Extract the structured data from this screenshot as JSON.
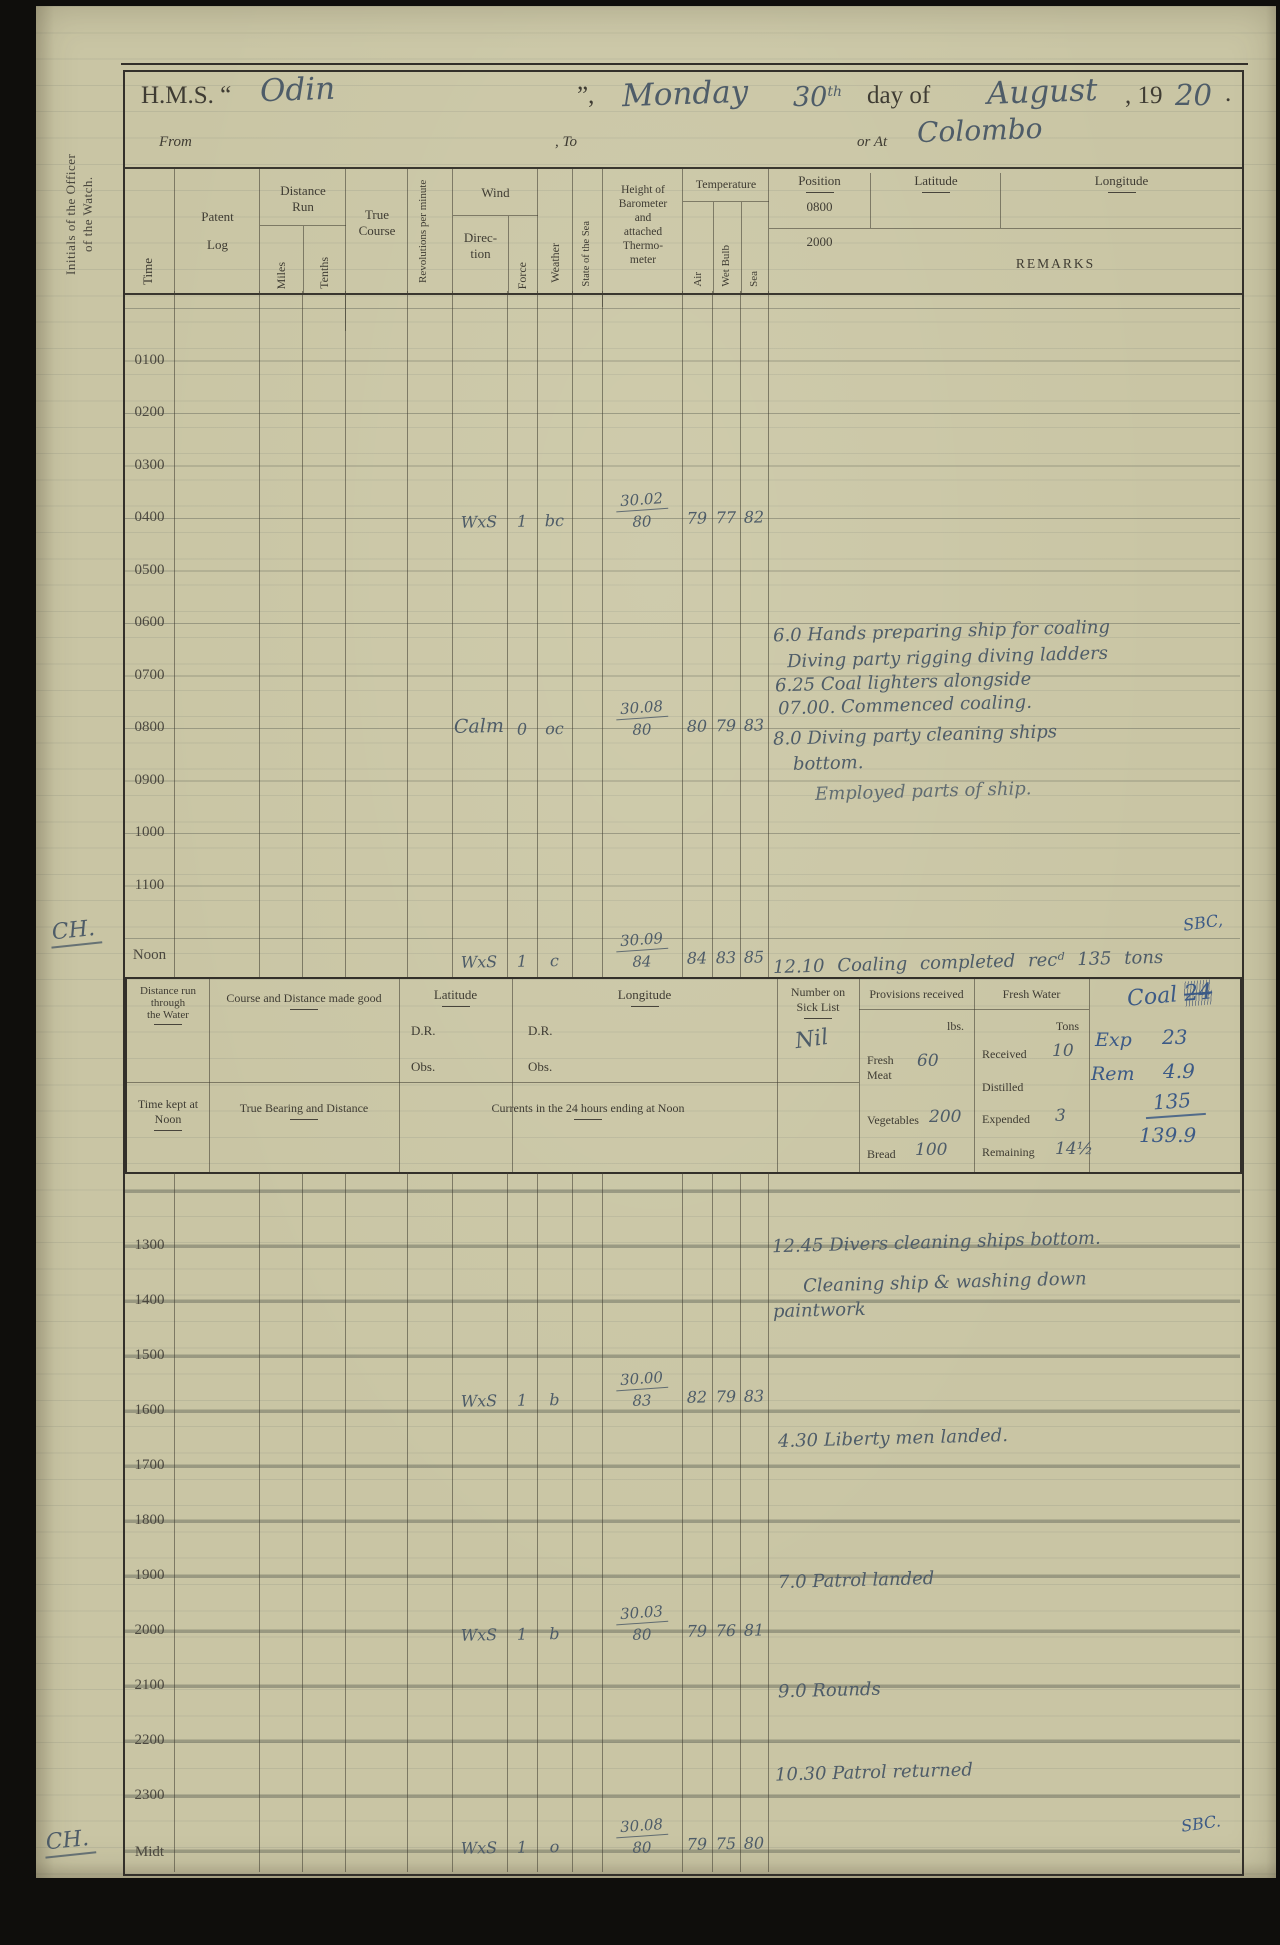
{
  "page": {
    "title_prefix": "H.M.S. “",
    "ship_name": "Odin",
    "title_mid": "”,",
    "day_name": "Monday",
    "day_number": "30",
    "day_ordinal": "th",
    "day_of_text": "day of",
    "month": "August",
    "year_prefix": ", 19",
    "year_hw": "20",
    "year_period": ".",
    "from_label": "From",
    "to_label": ", To",
    "or_at_label": "or At",
    "location": "Colombo"
  },
  "margin": {
    "initials_label": "Initials of the Officer\nof the Watch.",
    "noon_initials": "CH.",
    "midnight_initials": "CH."
  },
  "table": {
    "col_time": "Time",
    "col_patent_1": "Patent",
    "col_patent_2": "Log",
    "col_distance_run": "Distance\nRun",
    "col_miles": "Miles",
    "col_tenths": "Tenths",
    "col_true_course": "True\nCourse",
    "col_revolutions": "Revolutions per minute",
    "col_wind": "Wind",
    "col_direction": "Direc-\ntion",
    "col_force": "Force",
    "col_weather": "Weather",
    "col_state_sea": "State of the Sea",
    "col_barometer": "Height of\nBarometer\nand\nattached\nThermo-\nmeter",
    "col_temperature": "Temperature",
    "col_air": "Air",
    "col_wet_bulb": "Wet Bulb",
    "col_sea": "Sea",
    "col_position": "Position",
    "pos_row_1": "0800",
    "pos_row_2": "2000",
    "col_latitude": "Latitude",
    "col_longitude": "Longitude",
    "col_remarks": "REMARKS",
    "times_top": [
      "0100",
      "0200",
      "0300",
      "0400",
      "0500",
      "0600",
      "0700",
      "0800",
      "0900",
      "1000",
      "1100",
      "Noon"
    ],
    "times_bottom": [
      "1300",
      "1400",
      "1500",
      "1600",
      "1700",
      "1800",
      "1900",
      "2000",
      "2100",
      "2200",
      "2300",
      "Midt"
    ]
  },
  "observations": {
    "h0400": {
      "wind_direction": "WxS",
      "force": "1",
      "weather": "bc",
      "barometer_top": "30.02",
      "barometer_bottom": "80",
      "air": "79",
      "wet_bulb": "77",
      "sea": "82"
    },
    "h0800": {
      "wind_direction": "Calm",
      "force": "0",
      "weather": "oc",
      "barometer_top": "30.08",
      "barometer_bottom": "80",
      "air": "80",
      "wet_bulb": "79",
      "sea": "83"
    },
    "noon": {
      "wind_direction": "WxS",
      "force": "1",
      "weather": "c",
      "barometer_top": "30.09",
      "barometer_bottom": "84",
      "air": "84",
      "wet_bulb": "83",
      "sea": "85"
    },
    "h1600": {
      "wind_direction": "WxS",
      "force": "1",
      "weather": "b",
      "barometer_top": "30.00",
      "barometer_bottom": "83",
      "air": "82",
      "wet_bulb": "79",
      "sea": "83"
    },
    "h2000": {
      "wind_direction": "WxS",
      "force": "1",
      "weather": "b",
      "barometer_top": "30.03",
      "barometer_bottom": "80",
      "air": "79",
      "wet_bulb": "76",
      "sea": "81"
    },
    "midnight": {
      "wind_direction": "WxS",
      "force": "1",
      "weather": "o",
      "barometer_top": "30.08",
      "barometer_bottom": "80",
      "air": "79",
      "wet_bulb": "75",
      "sea": "80"
    }
  },
  "remarks": {
    "morning_1": "6.0 Hands preparing ship for coaling",
    "morning_2": "Diving party rigging diving ladders",
    "morning_3": "6.25 Coal lighters alongside",
    "morning_4": "07.00. Commenced coaling.",
    "forenoon_1": "8.0 Diving party cleaning ships",
    "forenoon_2": "bottom.",
    "forenoon_3": "Employed parts of ship.",
    "noon_entry": "12.10 Coaling completed recᵈ 135 tons",
    "noon_watch_initials": "SBC,",
    "afternoon_1": "12.45 Divers cleaning ships bottom.",
    "afternoon_2": "Cleaning ship & washing down",
    "afternoon_3": "paintwork",
    "evening_1600": "4.30 Liberty men landed.",
    "evening_1900": "7.0 Patrol landed",
    "night_2100": "9.0 Rounds",
    "night_2200": "10.30 Patrol returned",
    "midnight_watch_initials": "SBC."
  },
  "noon_summary": {
    "distance_water_label": "Distance run through\nthe Water",
    "course_made_good_label": "Course and Distance made good",
    "latitude_label": "Latitude",
    "longitude_label": "Longitude",
    "dr_label": "D.R.",
    "obs_label": "Obs.",
    "time_kept_label": "Time kept at\nNoon",
    "true_bearing_label": "True Bearing and Distance",
    "currents_label": "Currents in the 24 hours ending at Noon",
    "sick_list_label": "Number on\nSick List",
    "sick_list_value": "Nil",
    "provisions_label": "Provisions received",
    "lbs_label": "lbs.",
    "fresh_meat_label": "Fresh\nMeat",
    "fresh_meat_value": "60",
    "vegetables_label": "Vegetables",
    "vegetables_value": "200",
    "bread_label": "Bread",
    "bread_value": "100",
    "fresh_water_label": "Fresh Water",
    "tons_label": "Tons",
    "received_label": "Received",
    "received_value": "10",
    "distilled_label": "Distilled",
    "expended_label": "Expended",
    "expended_value": "3",
    "remaining_label": "Remaining",
    "remaining_value": "14½",
    "coal_title": "Coal",
    "coal_crossed_out": "24",
    "coal_exp_label": "Exp",
    "coal_exp_value": "23",
    "coal_rem_label": "Rem",
    "coal_rem_value": "4.9",
    "coal_received_value": "135",
    "coal_total_value": "139.9"
  }
}
